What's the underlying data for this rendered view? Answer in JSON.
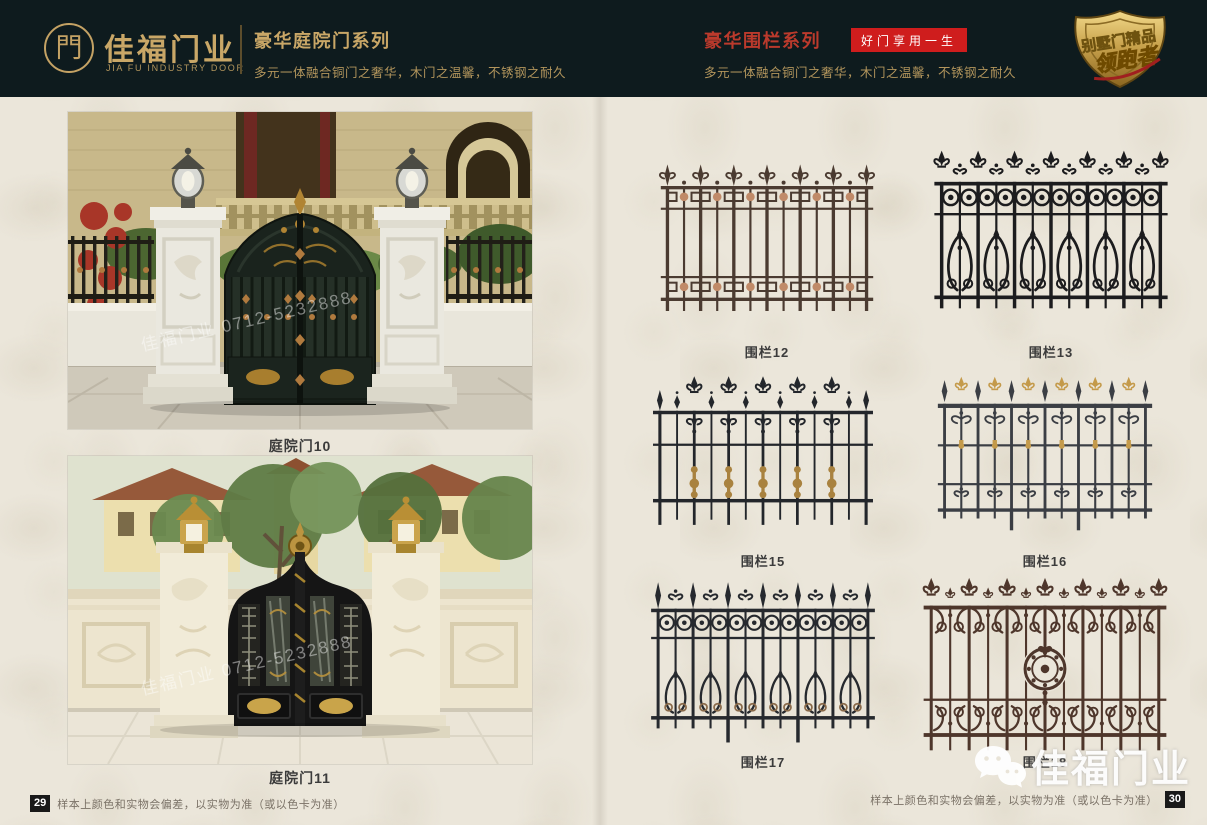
{
  "colors": {
    "header_bg": "#0e1b1e",
    "gold": "#c9a767",
    "gold_dim": "#b2955c",
    "title_red": "#bb3a2c",
    "badge_red": "#cf1d1d",
    "page_bg": "#ebe6da",
    "label_dark": "#3b3b3b",
    "footer_text": "#7a7166",
    "page_num_bg": "#191919"
  },
  "header": {
    "brand": {
      "logo_glyph": "門",
      "name": "佳福门业",
      "name_en": "JIA FU INDUSTRY DOOR"
    },
    "left_series": {
      "title": "豪华庭院门系列",
      "subtitle": "多元一体融合铜门之奢华，木门之温馨，不锈钢之耐久"
    },
    "right_series": {
      "title": "豪华围栏系列",
      "tagline": "好门享用一生",
      "subtitle": "多元一体融合铜门之奢华，木门之温馨，不锈钢之耐久"
    },
    "badge": {
      "line1": "别墅门精品",
      "line2": "领跑者"
    }
  },
  "left_page": {
    "products": [
      {
        "label": "庭院门10",
        "watermark": "佳福门业 0712-5232888"
      },
      {
        "label": "庭院门11",
        "watermark": "佳福门业 0712-5232888"
      }
    ],
    "footer": {
      "page_number": "29",
      "note": "样本上颜色和实物会偏差，以实物为准（或以色卡为准）"
    }
  },
  "right_page": {
    "products": [
      {
        "label": "围栏12",
        "variant": "greek",
        "color": "#4b3b31",
        "accent": "#c08a68"
      },
      {
        "label": "围栏13",
        "variant": "rings",
        "color": "#1c1c1e",
        "accent": "#1c1c1e"
      },
      {
        "label": "围栏15",
        "variant": "fleur",
        "color": "#23262b",
        "accent": "#a9823f"
      },
      {
        "label": "围栏16",
        "variant": "scroll",
        "color": "#3b3e44",
        "accent": "#c49a4a"
      },
      {
        "label": "围栏17",
        "variant": "rings2",
        "color": "#26292e",
        "accent": "#8a6a4a"
      },
      {
        "label": "围栏18",
        "variant": "medallion",
        "color": "#4e362b",
        "accent": "#6e4a38"
      }
    ],
    "footer": {
      "page_number": "30",
      "note": "样本上颜色和实物会偏差，以实物为准（或以色卡为准）"
    }
  },
  "watermark": {
    "text": "佳福门业"
  }
}
